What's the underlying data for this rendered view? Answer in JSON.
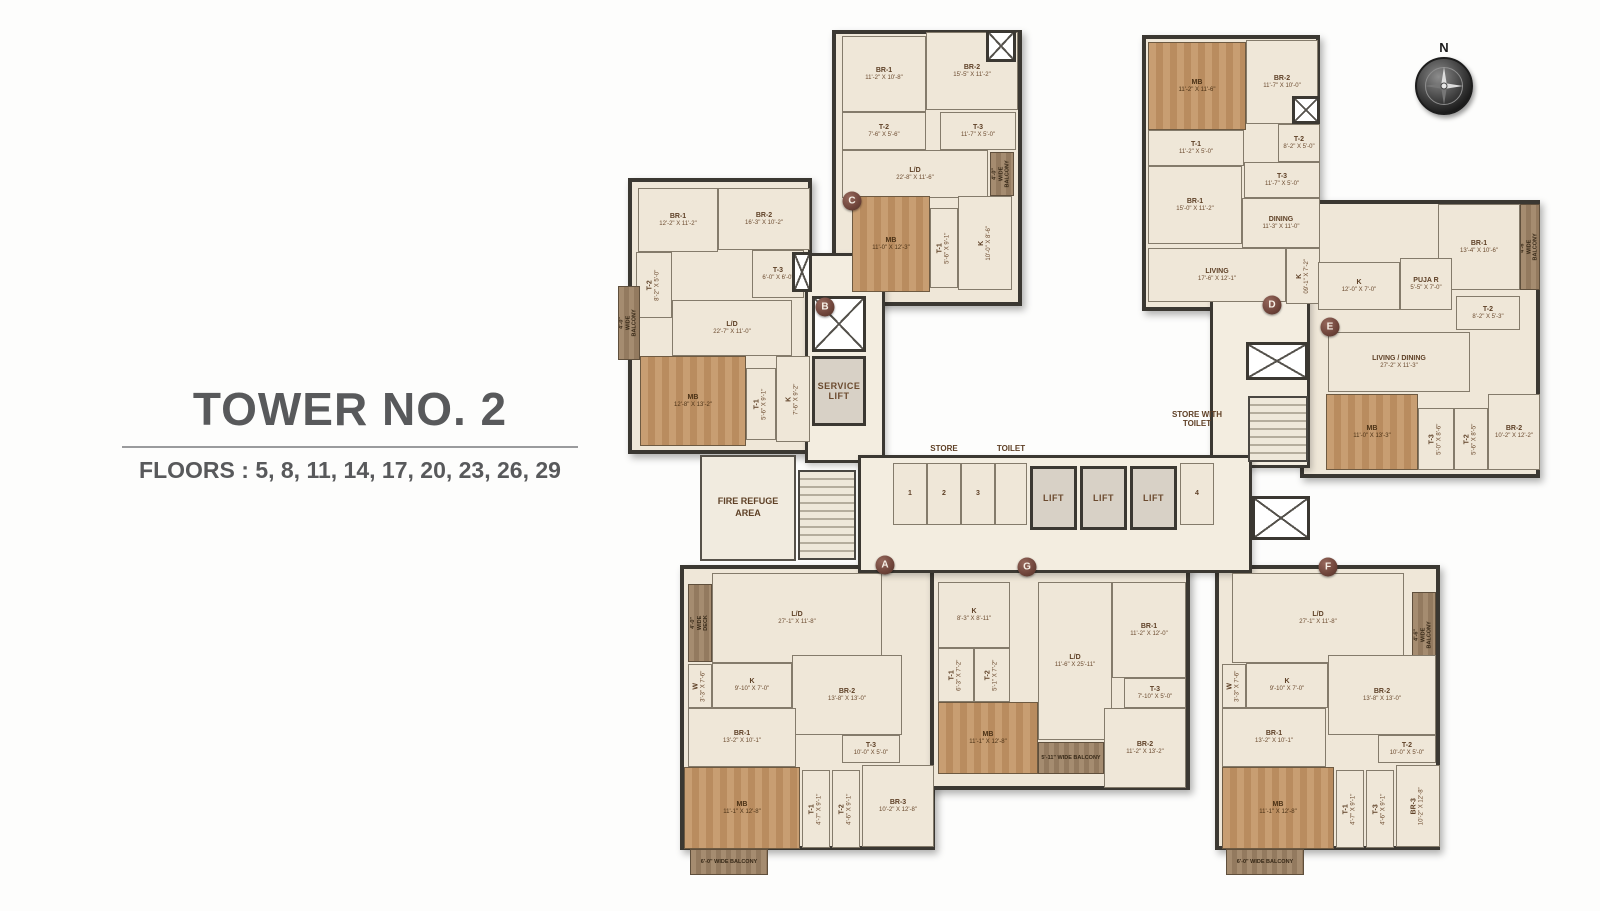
{
  "title": {
    "tower": "TOWER NO. 2",
    "floors": "FLOORS : 5, 8, 11, 14, 17, 20, 23, 26, 29"
  },
  "compass": {
    "north": "N"
  },
  "colors": {
    "wall": "#3b3832",
    "room_fill": "#efe7d8",
    "wood": "#c89e72",
    "label_brown": "#5e4026",
    "marker": "#6d4339",
    "title_gray": "#58595b"
  },
  "markers": [
    {
      "letter": "A",
      "x": 285,
      "y": 557
    },
    {
      "letter": "B",
      "x": 225,
      "y": 299
    },
    {
      "letter": "C",
      "x": 252,
      "y": 193
    },
    {
      "letter": "D",
      "x": 672,
      "y": 297
    },
    {
      "letter": "E",
      "x": 730,
      "y": 319
    },
    {
      "letter": "F",
      "x": 728,
      "y": 559
    },
    {
      "letter": "G",
      "x": 427,
      "y": 559
    }
  ],
  "wings": [
    {
      "id": "B",
      "x": 28,
      "y": 170,
      "w": 184,
      "h": 276
    },
    {
      "id": "C",
      "x": 232,
      "y": 22,
      "w": 190,
      "h": 276
    },
    {
      "id": "D",
      "x": 542,
      "y": 27,
      "w": 178,
      "h": 276
    },
    {
      "id": "E",
      "x": 700,
      "y": 192,
      "w": 240,
      "h": 278
    },
    {
      "id": "A",
      "x": 80,
      "y": 557,
      "w": 255,
      "h": 285
    },
    {
      "id": "G",
      "x": 330,
      "y": 557,
      "w": 260,
      "h": 225
    },
    {
      "id": "F",
      "x": 615,
      "y": 557,
      "w": 225,
      "h": 285
    }
  ],
  "corridors": [
    {
      "x": 205,
      "y": 245,
      "w": 80,
      "h": 210
    },
    {
      "x": 610,
      "y": 282,
      "w": 100,
      "h": 178
    },
    {
      "x": 258,
      "y": 447,
      "w": 394,
      "h": 118
    }
  ],
  "float_labels": [
    {
      "t": "STORE",
      "x": 294,
      "y": 436,
      "w": 100
    },
    {
      "t": "TOILET",
      "x": 381,
      "y": 436,
      "w": 60
    },
    {
      "t": "STORE WITH TOILET",
      "x": 561,
      "y": 402,
      "w": 72
    }
  ],
  "rooms": [
    {
      "n": "BR-1",
      "d": "12'-2\" X 11'-2\"",
      "x": 38,
      "y": 180,
      "w": 80,
      "h": 64,
      "k": "room"
    },
    {
      "n": "BR-2",
      "d": "16'-3\" X 10'-2\"",
      "x": 118,
      "y": 180,
      "w": 92,
      "h": 62,
      "k": "room"
    },
    {
      "n": "T-2",
      "d": "8'-2\" X 5'-0\"",
      "x": 36,
      "y": 244,
      "w": 36,
      "h": 66,
      "k": "room",
      "v": 1
    },
    {
      "n": "T-3",
      "d": "6'-0\" X 6'-0\"",
      "x": 152,
      "y": 242,
      "w": 52,
      "h": 48,
      "k": "room"
    },
    {
      "n": "L/D",
      "d": "22'-7\" X 11'-0\"",
      "x": 72,
      "y": 292,
      "w": 120,
      "h": 56,
      "k": "room"
    },
    {
      "n": "MB",
      "d": "12'-8\" X 13'-2\"",
      "x": 40,
      "y": 348,
      "w": 106,
      "h": 90,
      "k": "wood"
    },
    {
      "n": "T-1",
      "d": "5'-6\" X 9'-1\"",
      "x": 146,
      "y": 360,
      "w": 30,
      "h": 72,
      "k": "room",
      "v": 1
    },
    {
      "n": "K",
      "d": "7'-6\" X 9'-2\"",
      "x": 176,
      "y": 348,
      "w": 34,
      "h": 86,
      "k": "room",
      "v": 1
    },
    {
      "n": "4'-0\" WIDE BALCONY",
      "x": 18,
      "y": 278,
      "w": 22,
      "h": 74,
      "k": "balc",
      "v": 1
    },
    {
      "x": 192,
      "y": 244,
      "w": 20,
      "h": 40,
      "k": "shaft"
    },
    {
      "n": "BR-1",
      "d": "11'-2\" X 10'-8\"",
      "x": 242,
      "y": 28,
      "w": 84,
      "h": 76,
      "k": "room"
    },
    {
      "n": "BR-2",
      "d": "15'-5\" X 11'-2\"",
      "x": 326,
      "y": 24,
      "w": 92,
      "h": 78,
      "k": "room"
    },
    {
      "n": "T-2",
      "d": "7'-6\" X 5'-6\"",
      "x": 242,
      "y": 104,
      "w": 84,
      "h": 38,
      "k": "room"
    },
    {
      "n": "T-3",
      "d": "11'-7\" X 5'-0\"",
      "x": 340,
      "y": 104,
      "w": 76,
      "h": 38,
      "k": "room"
    },
    {
      "n": "L/D",
      "d": "22'-8\" X 11'-6\"",
      "x": 242,
      "y": 142,
      "w": 146,
      "h": 48,
      "k": "room"
    },
    {
      "n": "4'-0\" WIDE BALCONY",
      "x": 390,
      "y": 144,
      "w": 24,
      "h": 44,
      "k": "balc",
      "v": 1
    },
    {
      "n": "MB",
      "d": "11'-0\" X 12'-3\"",
      "x": 252,
      "y": 188,
      "w": 78,
      "h": 96,
      "k": "wood"
    },
    {
      "n": "T-1",
      "d": "5'-6\" X 9'-1\"",
      "x": 330,
      "y": 200,
      "w": 28,
      "h": 80,
      "k": "room",
      "v": 1
    },
    {
      "n": "K",
      "d": "10'-0\" X 8'-6\"",
      "x": 358,
      "y": 188,
      "w": 54,
      "h": 94,
      "k": "room",
      "v": 1
    },
    {
      "x": 386,
      "y": 22,
      "w": 30,
      "h": 32,
      "k": "shaft"
    },
    {
      "n": "MB",
      "d": "11'-2\" X 11'-6\"",
      "x": 548,
      "y": 34,
      "w": 98,
      "h": 88,
      "k": "wood"
    },
    {
      "n": "BR-2",
      "d": "11'-7\" X 10'-0\"",
      "x": 646,
      "y": 32,
      "w": 72,
      "h": 84,
      "k": "room"
    },
    {
      "n": "T-1",
      "d": "11'-2\" X 5'-0\"",
      "x": 548,
      "y": 122,
      "w": 96,
      "h": 36,
      "k": "room"
    },
    {
      "n": "T-2",
      "d": "8'-2\" X 5'-0\"",
      "x": 678,
      "y": 116,
      "w": 42,
      "h": 38,
      "k": "room"
    },
    {
      "n": "T-3",
      "d": "11'-7\" X 5'-0\"",
      "x": 644,
      "y": 154,
      "w": 76,
      "h": 36,
      "k": "room"
    },
    {
      "n": "BR-1",
      "d": "15'-0\" X 11'-2\"",
      "x": 548,
      "y": 158,
      "w": 94,
      "h": 78,
      "k": "room"
    },
    {
      "n": "DINING",
      "d": "11'-3\" X 11'-0\"",
      "x": 642,
      "y": 190,
      "w": 78,
      "h": 50,
      "k": "room"
    },
    {
      "n": "LIVING",
      "d": "17'-6\" X 12'-1\"",
      "x": 548,
      "y": 240,
      "w": 138,
      "h": 54,
      "k": "room"
    },
    {
      "n": "K",
      "d": "09'-1\" X 7'-2\"",
      "x": 686,
      "y": 240,
      "w": 34,
      "h": 56,
      "k": "room",
      "v": 1
    },
    {
      "x": 692,
      "y": 88,
      "w": 28,
      "h": 28,
      "k": "shaft"
    },
    {
      "n": "BR-1",
      "d": "13'-4\" X 10'-6\"",
      "x": 838,
      "y": 196,
      "w": 82,
      "h": 86,
      "k": "room"
    },
    {
      "n": "4'-6\" WIDE BALCONY",
      "x": 920,
      "y": 196,
      "w": 20,
      "h": 86,
      "k": "balc",
      "v": 1
    },
    {
      "n": "K",
      "d": "12'-0\" X 7'-0\"",
      "x": 718,
      "y": 254,
      "w": 82,
      "h": 48,
      "k": "room"
    },
    {
      "n": "PUJA R",
      "d": "5'-5\" X 7'-0\"",
      "x": 800,
      "y": 250,
      "w": 52,
      "h": 52,
      "k": "room"
    },
    {
      "n": "T-2",
      "d": "8'-2\" X 5'-3\"",
      "x": 856,
      "y": 288,
      "w": 64,
      "h": 34,
      "k": "room"
    },
    {
      "n": "LIVING / DINING",
      "d": "27'-2\" X 11'-3\"",
      "x": 728,
      "y": 324,
      "w": 142,
      "h": 60,
      "k": "room"
    },
    {
      "n": "MB",
      "d": "11'-0\" X 13'-3\"",
      "x": 726,
      "y": 386,
      "w": 92,
      "h": 76,
      "k": "wood"
    },
    {
      "n": "T-3",
      "d": "5'-0\" X 8'-6\"",
      "x": 818,
      "y": 400,
      "w": 36,
      "h": 62,
      "k": "room",
      "v": 1
    },
    {
      "n": "T-2",
      "d": "5'-6\" X 8'-5\"",
      "x": 854,
      "y": 400,
      "w": 34,
      "h": 62,
      "k": "room",
      "v": 1
    },
    {
      "n": "BR-2",
      "d": "10'-2\" X 12'-2\"",
      "x": 888,
      "y": 386,
      "w": 52,
      "h": 76,
      "k": "room"
    },
    {
      "n": "FIRE REFUGE AREA",
      "x": 100,
      "y": 447,
      "w": 96,
      "h": 106,
      "k": "core"
    },
    {
      "x": 198,
      "y": 462,
      "w": 58,
      "h": 90,
      "k": "stair"
    },
    {
      "x": 212,
      "y": 288,
      "w": 54,
      "h": 56,
      "k": "shaft"
    },
    {
      "n": "SERVICE LIFT",
      "x": 212,
      "y": 348,
      "w": 54,
      "h": 70,
      "k": "lift"
    },
    {
      "n": "1",
      "x": 293,
      "y": 455,
      "w": 34,
      "h": 62,
      "k": "room"
    },
    {
      "n": "2",
      "x": 327,
      "y": 455,
      "w": 34,
      "h": 62,
      "k": "room"
    },
    {
      "n": "3",
      "x": 361,
      "y": 455,
      "w": 34,
      "h": 62,
      "k": "room"
    },
    {
      "x": 395,
      "y": 455,
      "w": 32,
      "h": 62,
      "k": "room"
    },
    {
      "n": "LIFT",
      "x": 430,
      "y": 458,
      "w": 47,
      "h": 64,
      "k": "lift"
    },
    {
      "n": "LIFT",
      "x": 480,
      "y": 458,
      "w": 47,
      "h": 64,
      "k": "lift"
    },
    {
      "n": "LIFT",
      "x": 530,
      "y": 458,
      "w": 47,
      "h": 64,
      "k": "lift"
    },
    {
      "n": "4",
      "x": 580,
      "y": 455,
      "w": 34,
      "h": 62,
      "k": "room"
    },
    {
      "x": 646,
      "y": 334,
      "w": 62,
      "h": 38,
      "k": "shaft"
    },
    {
      "x": 648,
      "y": 388,
      "w": 60,
      "h": 66,
      "k": "stair"
    },
    {
      "x": 652,
      "y": 488,
      "w": 58,
      "h": 44,
      "k": "shaft"
    },
    {
      "n": "4'-0\" WIDE DECK",
      "x": 88,
      "y": 576,
      "w": 24,
      "h": 78,
      "k": "balc",
      "v": 1
    },
    {
      "n": "L/D",
      "d": "27'-1\" X 11'-8\"",
      "x": 112,
      "y": 565,
      "w": 170,
      "h": 90,
      "k": "room"
    },
    {
      "n": "W",
      "d": "3'-3\" X 7'-6\"",
      "x": 88,
      "y": 656,
      "w": 24,
      "h": 44,
      "k": "room",
      "v": 1
    },
    {
      "n": "K",
      "d": "9'-10\" X 7'-0\"",
      "x": 112,
      "y": 655,
      "w": 80,
      "h": 45,
      "k": "room"
    },
    {
      "n": "BR-2",
      "d": "13'-8\" X 13'-0\"",
      "x": 192,
      "y": 647,
      "w": 110,
      "h": 80,
      "k": "room"
    },
    {
      "n": "BR-1",
      "d": "13'-2\" X 10'-1\"",
      "x": 88,
      "y": 700,
      "w": 108,
      "h": 59,
      "k": "room"
    },
    {
      "n": "T-3",
      "d": "10'-0\" X 5'-0\"",
      "x": 242,
      "y": 727,
      "w": 58,
      "h": 28,
      "k": "room"
    },
    {
      "n": "MB",
      "d": "11'-1\" X 12'-8\"",
      "x": 84,
      "y": 759,
      "w": 116,
      "h": 82,
      "k": "wood"
    },
    {
      "n": "T-1",
      "d": "4'-7\" X 9'-1\"",
      "x": 202,
      "y": 762,
      "w": 28,
      "h": 78,
      "k": "room",
      "v": 1
    },
    {
      "n": "T-2",
      "d": "4'-6\" X 9'-1\"",
      "x": 232,
      "y": 762,
      "w": 28,
      "h": 78,
      "k": "room",
      "v": 1
    },
    {
      "n": "BR-3",
      "d": "10'-2\" X 12'-8\"",
      "x": 262,
      "y": 757,
      "w": 72,
      "h": 82,
      "k": "room"
    },
    {
      "n": "6'-0\" WIDE BALCONY",
      "x": 90,
      "y": 841,
      "w": 78,
      "h": 26,
      "k": "balc"
    },
    {
      "n": "K",
      "d": "8'-3\" X 8'-11\"",
      "x": 338,
      "y": 574,
      "w": 72,
      "h": 66,
      "k": "room"
    },
    {
      "n": "T-1",
      "d": "6'-3\" X 7'-2\"",
      "x": 338,
      "y": 640,
      "w": 36,
      "h": 54,
      "k": "room",
      "v": 1
    },
    {
      "n": "T-2",
      "d": "5'-1\" X 7'-2\"",
      "x": 374,
      "y": 640,
      "w": 36,
      "h": 54,
      "k": "room",
      "v": 1
    },
    {
      "n": "MB",
      "d": "11'-1\" X 12'-8\"",
      "x": 338,
      "y": 694,
      "w": 100,
      "h": 72,
      "k": "wood"
    },
    {
      "n": "L/D",
      "d": "11'-6\" X 25'-11\"",
      "x": 438,
      "y": 574,
      "w": 74,
      "h": 158,
      "k": "room"
    },
    {
      "n": "BR-1",
      "d": "11'-2\" X 12'-0\"",
      "x": 512,
      "y": 574,
      "w": 74,
      "h": 96,
      "k": "room"
    },
    {
      "n": "T-3",
      "d": "7'-10\" X 5'-0\"",
      "x": 524,
      "y": 670,
      "w": 62,
      "h": 30,
      "k": "room"
    },
    {
      "n": "5'-11\" WIDE BALCONY",
      "x": 438,
      "y": 734,
      "w": 66,
      "h": 32,
      "k": "balc"
    },
    {
      "n": "BR-2",
      "d": "11'-2\" X 13'-2\"",
      "x": 504,
      "y": 700,
      "w": 82,
      "h": 80,
      "k": "room"
    },
    {
      "n": "L/D",
      "d": "27'-1\" X 11'-8\"",
      "x": 632,
      "y": 565,
      "w": 172,
      "h": 90,
      "k": "room"
    },
    {
      "n": "4'-6\" WIDE BALCONY",
      "x": 812,
      "y": 584,
      "w": 24,
      "h": 86,
      "k": "balc",
      "v": 1
    },
    {
      "n": "W",
      "d": "3'-3\" X 7'-6\"",
      "x": 622,
      "y": 656,
      "w": 24,
      "h": 44,
      "k": "room",
      "v": 1
    },
    {
      "n": "K",
      "d": "9'-10\" X 7'-0\"",
      "x": 646,
      "y": 655,
      "w": 82,
      "h": 45,
      "k": "room"
    },
    {
      "n": "BR-2",
      "d": "13'-8\" X 13'-0\"",
      "x": 728,
      "y": 647,
      "w": 108,
      "h": 80,
      "k": "room"
    },
    {
      "n": "BR-1",
      "d": "13'-2\" X 10'-1\"",
      "x": 622,
      "y": 700,
      "w": 104,
      "h": 59,
      "k": "room"
    },
    {
      "n": "T-2",
      "d": "10'-0\" X 5'-0\"",
      "x": 778,
      "y": 727,
      "w": 58,
      "h": 28,
      "k": "room"
    },
    {
      "n": "MB",
      "d": "11'-1\" X 12'-8\"",
      "x": 622,
      "y": 759,
      "w": 112,
      "h": 82,
      "k": "wood"
    },
    {
      "n": "T-1",
      "d": "4'-7\" X 9'-1\"",
      "x": 736,
      "y": 762,
      "w": 28,
      "h": 78,
      "k": "room",
      "v": 1
    },
    {
      "n": "T-3",
      "d": "4'-6\" X 9'-1\"",
      "x": 766,
      "y": 762,
      "w": 28,
      "h": 78,
      "k": "room",
      "v": 1
    },
    {
      "n": "BR-3",
      "d": "10'-2\" X 12'-8\"",
      "x": 796,
      "y": 757,
      "w": 44,
      "h": 82,
      "k": "room",
      "v": 1
    },
    {
      "n": "6'-0\" WIDE BALCONY",
      "x": 626,
      "y": 841,
      "w": 78,
      "h": 26,
      "k": "balc"
    }
  ]
}
